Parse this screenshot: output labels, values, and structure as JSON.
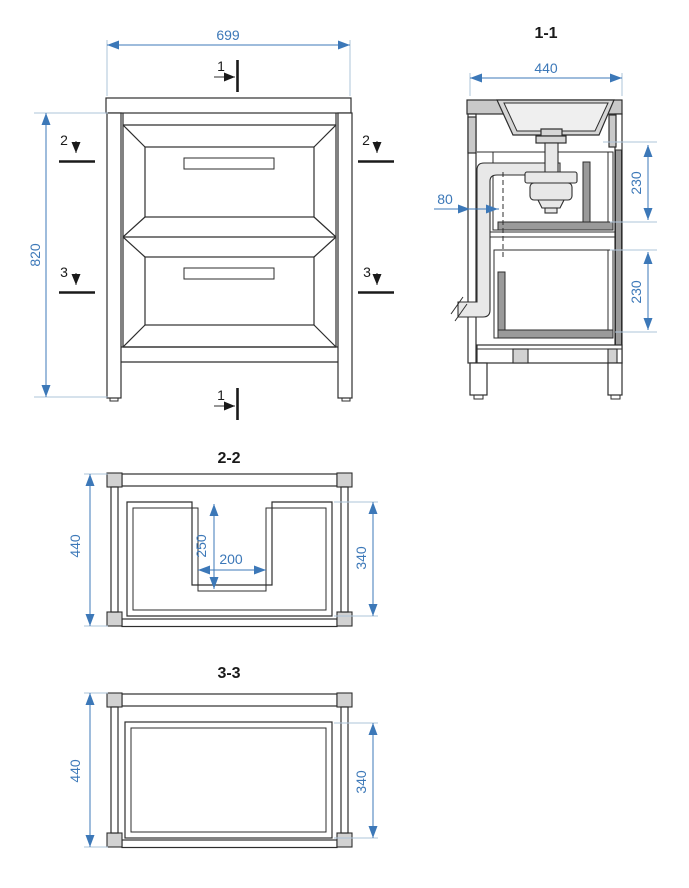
{
  "colors": {
    "line": "#2e2e2e",
    "dimension": "#3c78b8",
    "extension_line": "#aec4da",
    "light_gray_fill": "#d2d2d2",
    "dark_gray_fill": "#9a9a9a",
    "pipe_fill": "#e8e8e8"
  },
  "front": {
    "dim_width": "699",
    "dim_height": "820",
    "marker1": "1",
    "marker2": "2",
    "marker3": "3"
  },
  "s11": {
    "title": "1-1",
    "dim_depth": "440",
    "dim_upper_drawer": "230",
    "dim_lower_drawer": "230",
    "dim_siphon_offset": "80"
  },
  "s22": {
    "title": "2-2",
    "dim_depth": "440",
    "dim_drawer_inner": "340",
    "dim_notch_depth": "250",
    "dim_notch_width": "200"
  },
  "s33": {
    "title": "3-3",
    "dim_depth": "440",
    "dim_drawer_inner": "340"
  }
}
